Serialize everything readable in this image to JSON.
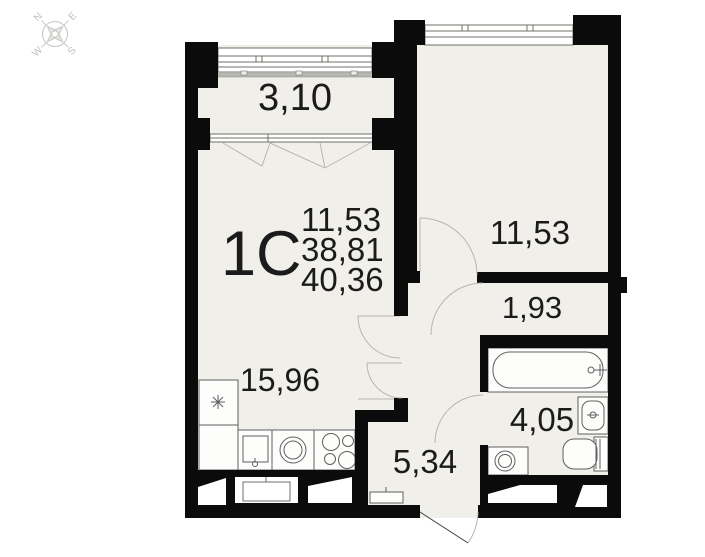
{
  "compass": {
    "north": "N",
    "east": "E",
    "south": "S",
    "west": "W"
  },
  "apartment": {
    "type_label": "1С",
    "stacked_values": [
      "11,53",
      "38,81",
      "40,36"
    ]
  },
  "rooms": {
    "balcony": "3,10",
    "bedroom": "11,53",
    "corridor": "1,93",
    "kitchen_living": "15,96",
    "bathroom": "4,05",
    "hallway": "5,34"
  },
  "colors": {
    "wall": "#0b0b0b",
    "floor": "#f1efea",
    "fixture_stroke": "#5f5f5f",
    "door_arc": "#b6b6b0",
    "compass": "#c5c5c3",
    "text": "#1b1b1b"
  }
}
